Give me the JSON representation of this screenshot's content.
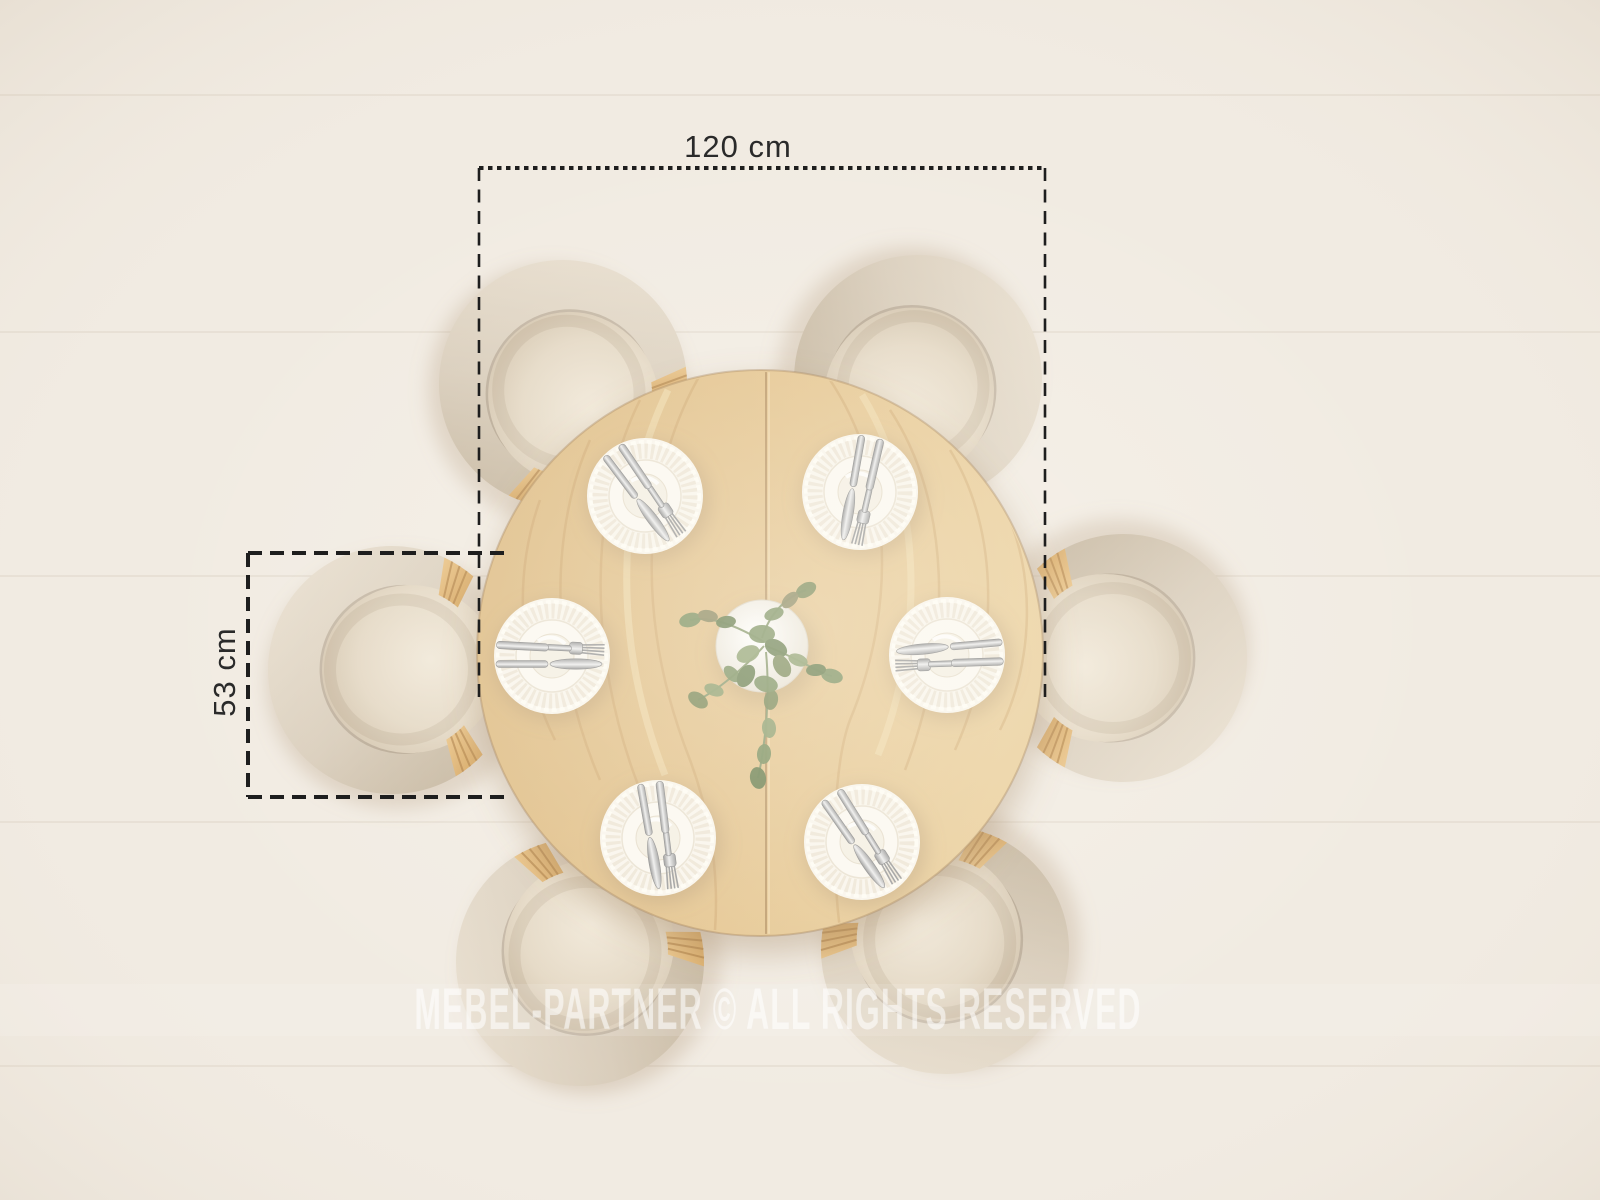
{
  "scene": {
    "description": "Top view of a round oak dining table set with six plates, cutlery and a eucalyptus centerpiece, surrounded by six beige horseshoe-back chairs on a pale wooden floor",
    "watermark": "MEBEL-PARTNER © ALL RIGHTS RESERVED",
    "dimensions": {
      "table_width_label": "120 cm",
      "chair_width_label": "53 cm"
    },
    "chair_count": 6,
    "place_setting_count": 6,
    "table": {
      "cx": 760,
      "cy": 653,
      "radius": 283
    },
    "chairs": [
      {
        "x": 563,
        "y": 384,
        "rot": 54
      },
      {
        "x": 918,
        "y": 379,
        "rot": 120
      },
      {
        "x": 392,
        "y": 670,
        "rot": -3
      },
      {
        "x": 1123,
        "y": 658,
        "rot": 180
      },
      {
        "x": 580,
        "y": 962,
        "rot": -60
      },
      {
        "x": 945,
        "y": 950,
        "rot": -122
      }
    ],
    "place_settings": [
      {
        "x": 645,
        "y": 496,
        "cutlery_rot": -127
      },
      {
        "x": 860,
        "y": 492,
        "cutlery_rot": -80
      },
      {
        "x": 552,
        "y": 656,
        "cutlery_rot": 180
      },
      {
        "x": 947,
        "y": 655,
        "cutlery_rot": -5
      },
      {
        "x": 658,
        "y": 838,
        "cutlery_rot": -100
      },
      {
        "x": 862,
        "y": 842,
        "cutlery_rot": -125
      }
    ],
    "plant": {
      "x": 762,
      "y": 650
    }
  },
  "colors": {
    "floor": "#f1ebe2",
    "floor_plank_line": "#cdbfae",
    "table_wood": "#e3c28c",
    "wood_grain": "#c1955a",
    "wood_grain_light": "#f2e0b4",
    "chair_upholstery": "#d9cdbb",
    "chair_upholstery_dark": "#c3b49d",
    "seat_cushion": "#e9dfcf",
    "wood_accent": "#dcaa62",
    "plate": "#f9f5ec",
    "cutlery_silver": "#c9c9c9",
    "leaf_green": "#7c9160",
    "leaf_green_dark": "#697f4f",
    "dimension_line": "#1e1e1e",
    "dimension_text": "#2a2a2a",
    "watermark_white": "#ffffff"
  }
}
